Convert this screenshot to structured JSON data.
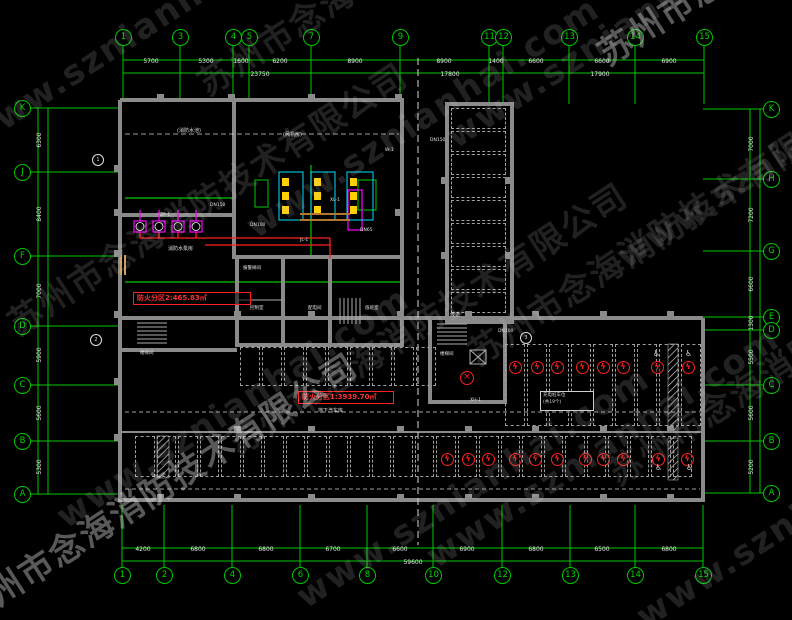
{
  "watermark": {
    "line_en": "www.sznianhai.com",
    "line_cn": "苏州市念海消防技术有限公司"
  },
  "colors": {
    "grid_green": "#00c800",
    "wall_gray": "#8a8a8a",
    "alarm_red": "#ff2020",
    "pump_magenta": "#ff00ff",
    "equip_cyan": "#00e0ff",
    "equip_yellow": "#ffd000",
    "background": "#000000"
  },
  "axes": {
    "top": [
      {
        "label": "1",
        "x": 123
      },
      {
        "label": "3",
        "x": 180
      },
      {
        "label": "4",
        "x": 233
      },
      {
        "label": "5",
        "x": 249
      },
      {
        "label": "7",
        "x": 311
      },
      {
        "label": "9",
        "x": 400
      },
      {
        "label": "11",
        "x": 489
      },
      {
        "label": "12",
        "x": 503
      },
      {
        "label": "13",
        "x": 569
      },
      {
        "label": "14",
        "x": 635
      },
      {
        "label": "15",
        "x": 704
      }
    ],
    "bottom": [
      {
        "label": "1",
        "x": 122
      },
      {
        "label": "2",
        "x": 164
      },
      {
        "label": "4",
        "x": 232
      },
      {
        "label": "6",
        "x": 300
      },
      {
        "label": "8",
        "x": 367
      },
      {
        "label": "10",
        "x": 433
      },
      {
        "label": "12",
        "x": 502
      },
      {
        "label": "13",
        "x": 570
      },
      {
        "label": "14",
        "x": 635
      },
      {
        "label": "15",
        "x": 703
      }
    ],
    "left": [
      {
        "label": "K",
        "y": 108
      },
      {
        "label": "J",
        "y": 172
      },
      {
        "label": "F",
        "y": 256
      },
      {
        "label": "D",
        "y": 326
      },
      {
        "label": "C",
        "y": 385
      },
      {
        "label": "B",
        "y": 441
      },
      {
        "label": "A",
        "y": 494
      }
    ],
    "right": [
      {
        "label": "K",
        "y": 109
      },
      {
        "label": "H",
        "y": 179
      },
      {
        "label": "G",
        "y": 251
      },
      {
        "label": "E",
        "y": 317
      },
      {
        "label": "D",
        "y": 330
      },
      {
        "label": "C",
        "y": 385
      },
      {
        "label": "B",
        "y": 441
      },
      {
        "label": "A",
        "y": 493
      }
    ]
  },
  "dims": [
    {
      "t": "5700",
      "x": 151,
      "y": 62
    },
    {
      "t": "5300",
      "x": 206,
      "y": 62
    },
    {
      "t": "1600",
      "x": 241,
      "y": 62
    },
    {
      "t": "6200",
      "x": 280,
      "y": 62
    },
    {
      "t": "8900",
      "x": 355,
      "y": 62
    },
    {
      "t": "8900",
      "x": 444,
      "y": 62
    },
    {
      "t": "1400",
      "x": 496,
      "y": 62
    },
    {
      "t": "6600",
      "x": 536,
      "y": 62
    },
    {
      "t": "6600",
      "x": 602,
      "y": 62
    },
    {
      "t": "6900",
      "x": 669,
      "y": 62
    },
    {
      "t": "23750",
      "x": 260,
      "y": 75
    },
    {
      "t": "17800",
      "x": 450,
      "y": 75
    },
    {
      "t": "17900",
      "x": 600,
      "y": 75
    },
    {
      "t": "4200",
      "x": 143,
      "y": 550
    },
    {
      "t": "6800",
      "x": 198,
      "y": 550
    },
    {
      "t": "6800",
      "x": 266,
      "y": 550
    },
    {
      "t": "6700",
      "x": 333,
      "y": 550
    },
    {
      "t": "6600",
      "x": 400,
      "y": 550
    },
    {
      "t": "6900",
      "x": 467,
      "y": 550
    },
    {
      "t": "6800",
      "x": 536,
      "y": 550
    },
    {
      "t": "6500",
      "x": 602,
      "y": 550
    },
    {
      "t": "6800",
      "x": 669,
      "y": 550
    },
    {
      "t": "59600",
      "x": 413,
      "y": 563
    },
    {
      "t": "6300",
      "x": 40,
      "y": 140,
      "rot": true
    },
    {
      "t": "8400",
      "x": 40,
      "y": 214,
      "rot": true
    },
    {
      "t": "7000",
      "x": 40,
      "y": 291,
      "rot": true
    },
    {
      "t": "5900",
      "x": 40,
      "y": 355,
      "rot": true
    },
    {
      "t": "5600",
      "x": 40,
      "y": 413,
      "rot": true
    },
    {
      "t": "5300",
      "x": 40,
      "y": 467,
      "rot": true
    },
    {
      "t": "7000",
      "x": 752,
      "y": 144,
      "rot": true
    },
    {
      "t": "7200",
      "x": 752,
      "y": 215,
      "rot": true
    },
    {
      "t": "6600",
      "x": 752,
      "y": 284,
      "rot": true
    },
    {
      "t": "1300",
      "x": 752,
      "y": 323,
      "rot": true
    },
    {
      "t": "5500",
      "x": 752,
      "y": 357,
      "rot": true
    },
    {
      "t": "5600",
      "x": 752,
      "y": 413,
      "rot": true
    },
    {
      "t": "5200",
      "x": 752,
      "y": 467,
      "rot": true
    }
  ],
  "fire_zones": [
    {
      "text": "防火分区2:465.83㎡"
    },
    {
      "text": "防火分区1:3939.70㎡"
    }
  ],
  "labels": [
    {
      "t": "(消防水池)",
      "x": 177,
      "y": 129,
      "s": 5
    },
    {
      "t": "(风机房)",
      "x": 283,
      "y": 133,
      "s": 5
    },
    {
      "t": "消防水泵房",
      "x": 168,
      "y": 247,
      "s": 5
    },
    {
      "t": "报警阀间",
      "x": 243,
      "y": 267,
      "s": 4.5
    },
    {
      "t": "控制室",
      "x": 250,
      "y": 307,
      "s": 4.5
    },
    {
      "t": "配电间",
      "x": 308,
      "y": 307,
      "s": 4.5
    },
    {
      "t": "值班室",
      "x": 365,
      "y": 307,
      "s": 4.5
    },
    {
      "t": "楼梯间",
      "x": 140,
      "y": 352,
      "s": 4.5
    },
    {
      "t": "楼梯间",
      "x": 440,
      "y": 353,
      "s": 4.5
    },
    {
      "t": "坡道",
      "x": 450,
      "y": 313,
      "s": 5
    },
    {
      "t": "地下汽车库",
      "x": 318,
      "y": 409,
      "s": 5
    },
    {
      "t": "DN150",
      "x": 210,
      "y": 204,
      "s": 4.5
    },
    {
      "t": "DN100",
      "x": 250,
      "y": 224,
      "s": 4.5
    },
    {
      "t": "ZP-1",
      "x": 160,
      "y": 214,
      "s": 4.5
    },
    {
      "t": "XL-1",
      "x": 330,
      "y": 199,
      "s": 4.5
    },
    {
      "t": "JL-1",
      "x": 300,
      "y": 239,
      "s": 4.5
    },
    {
      "t": "DN65",
      "x": 360,
      "y": 229,
      "s": 4.5
    },
    {
      "t": "W-1",
      "x": 385,
      "y": 149,
      "s": 4.5
    },
    {
      "t": "DN150",
      "x": 430,
      "y": 139,
      "s": 4.5
    },
    {
      "t": "DN100",
      "x": 498,
      "y": 330,
      "s": 4.5
    },
    {
      "t": "XH-1",
      "x": 470,
      "y": 399,
      "s": 4.5
    }
  ],
  "legend": {
    "line1": "充电桩车位",
    "line2": "(共19个)"
  },
  "callouts": [
    {
      "n": "1",
      "x": 97,
      "y": 159
    },
    {
      "n": "2",
      "x": 95,
      "y": 339
    },
    {
      "n": "3",
      "x": 525,
      "y": 337
    }
  ],
  "symbols": {
    "ev_glyph": "ϟ",
    "hydrant_glyph": "×",
    "accessible_glyph": "♿",
    "ev_mid": {
      "y": 367,
      "xs": [
        515,
        537,
        557,
        582,
        603,
        623,
        657,
        688
      ]
    },
    "ev_bottom": {
      "y": 459,
      "xs": [
        447,
        468,
        488,
        515,
        535,
        557,
        585,
        603,
        623,
        658,
        687
      ]
    },
    "hydrants": [
      {
        "x": 467,
        "y": 378
      }
    ],
    "accessible": [
      {
        "x": 653,
        "y": 350
      },
      {
        "x": 685,
        "y": 350
      },
      {
        "x": 655,
        "y": 464
      },
      {
        "x": 686,
        "y": 464
      }
    ]
  },
  "parking": {
    "rows": [
      {
        "name": "right-strip",
        "x": 451,
        "y": 108,
        "stall_w": 57,
        "stall_h": 23,
        "count": 9,
        "stack": "vertical"
      },
      {
        "name": "mid-ev-row",
        "x": 505,
        "y": 344,
        "stall_w": 22,
        "stall_h": 84,
        "count": 9,
        "stack": "horizontal"
      },
      {
        "name": "left-mid-row",
        "x": 240,
        "y": 347,
        "stall_w": 22,
        "stall_h": 41,
        "count": 9,
        "stack": "horizontal"
      },
      {
        "name": "bottom-row",
        "x": 135,
        "y": 436,
        "stall_w": 21.5,
        "stall_h": 43,
        "count": 26,
        "stack": "horizontal"
      }
    ]
  }
}
